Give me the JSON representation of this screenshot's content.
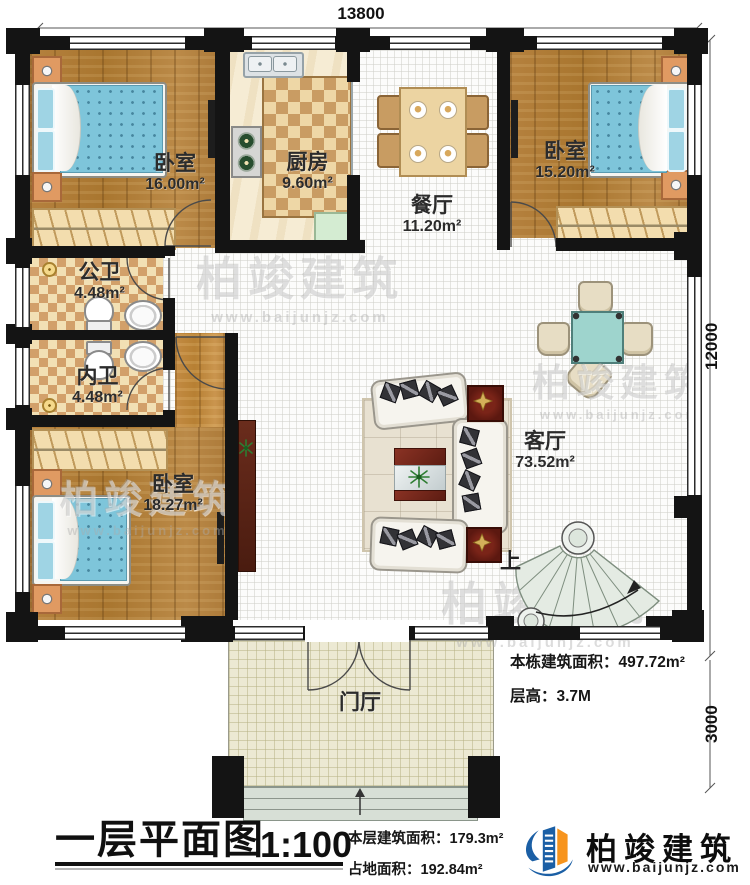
{
  "plan": {
    "dimensions": {
      "width_top": "13800",
      "height_right": "12000",
      "porch_height": "3000"
    },
    "rooms": {
      "bedroom_top_left": {
        "name": "卧室",
        "area": "16.00m²"
      },
      "kitchen": {
        "name": "厨房",
        "area": "9.60m²"
      },
      "dining": {
        "name": "餐厅",
        "area": "11.20m²"
      },
      "bedroom_top_right": {
        "name": "卧室",
        "area": "15.20m²"
      },
      "bath_public": {
        "name": "公卫",
        "area": "4.48m²"
      },
      "bath_private": {
        "name": "内卫",
        "area": "4.48m²"
      },
      "bedroom_bottom": {
        "name": "卧室",
        "area": "18.27m²"
      },
      "living": {
        "name": "客厅",
        "area": "73.52m²"
      },
      "foyer": {
        "name": "门厅"
      }
    },
    "stairs_label": "上",
    "notes": {
      "total_area": "本栋建筑面积：497.72m²",
      "floor_height": "层高：3.7M"
    }
  },
  "title_block": {
    "name": "一层平面图",
    "scale": "1:100",
    "floor_area": "本层建筑面积：179.3m²",
    "footprint": "占地面积：192.84m²"
  },
  "brand": {
    "company": "柏竣建筑",
    "website": "www.baijunjz.com"
  },
  "watermark": {
    "text": "柏竣建筑",
    "website": "www.baijunjz.com"
  }
}
